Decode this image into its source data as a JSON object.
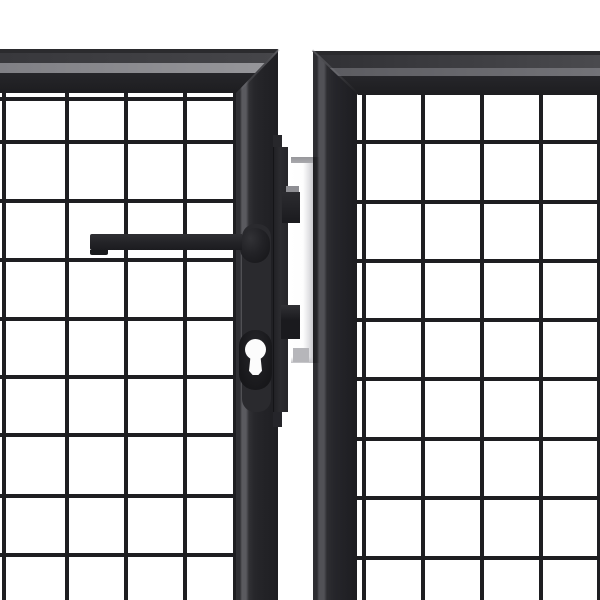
{
  "scene": {
    "type": "product-photo",
    "subject": "Close-up of an anthracite steel double garden gate: two welded-mesh leaves with square frame profiles, a dark lever handle and euro-profile cylinder keyhole on the left leaf, a flat lock bar with two keeper brackets, and a white galvanized post visible in the gap between the leaves",
    "background_color": "#ffffff"
  },
  "colors": {
    "bg": "#ffffff",
    "wire": "#1e1e21",
    "rail_edge_left": "#2b2b2e",
    "rail_top_left_a": "#38383c",
    "rail_top_left_b": "#46464a",
    "rail_strip_left_a": "#808085",
    "rail_strip_left_b": "#97979b",
    "rail_edge_right": "#2a2a2d",
    "rail_top_right_a": "#303034",
    "rail_top_right_b": "#4a4a4e",
    "rail_strip_right_a": "#5a5a5f",
    "rail_strip_right_b": "#737378",
    "rail_face_a": "#26262a",
    "rail_face_b": "#1d1d20",
    "bar_face": "#2c2c30",
    "plate": "#2a2a2e",
    "handle_a": "#2f2f33",
    "handle_b": "#1b1b1f",
    "handle_step": "#191a1c",
    "boss_a": "#323236",
    "boss_b": "#141417",
    "capsule_a": "#26262a",
    "capsule_b": "#17171a",
    "keyhole": "#fcfcfc",
    "post_a": "#ffffff",
    "post_b": "#c9c9cd",
    "post_top": "#a9a9ad",
    "post_tab": "#b6b6ba",
    "bracket_a": "#2c2c30",
    "bracket_b": "#1a1a1e",
    "bracket_top": "#8e8e93"
  },
  "mesh": {
    "wire_px": 4,
    "cell_size_px": 59,
    "left": {
      "area": {
        "x": 0,
        "y": 90,
        "w": 236,
        "h": 510
      },
      "cols": [
        2,
        65,
        124,
        183,
        233
      ],
      "rows": [
        97,
        140,
        199,
        258,
        317,
        375,
        433,
        494,
        553
      ]
    },
    "right": {
      "area": {
        "x": 357,
        "y": 92,
        "w": 243,
        "h": 508
      },
      "cols": [
        362,
        421,
        480,
        539,
        597
      ],
      "rows": [
        140,
        200,
        259,
        318,
        377,
        437,
        496,
        556
      ]
    }
  },
  "parts": {
    "left_leaf": "left gate leaf with handle and cylinder lock",
    "right_leaf": "right gate leaf",
    "handle": "dark lever handle with mounting boss",
    "lock": "white euro-profile cylinder keyhole in recessed capsule",
    "lock_bar": "flat vertical lock bar on the edge of the left leaf",
    "post": "white post seen in the gap between the leaves",
    "brackets": "two dark keeper brackets bridging to the post"
  }
}
